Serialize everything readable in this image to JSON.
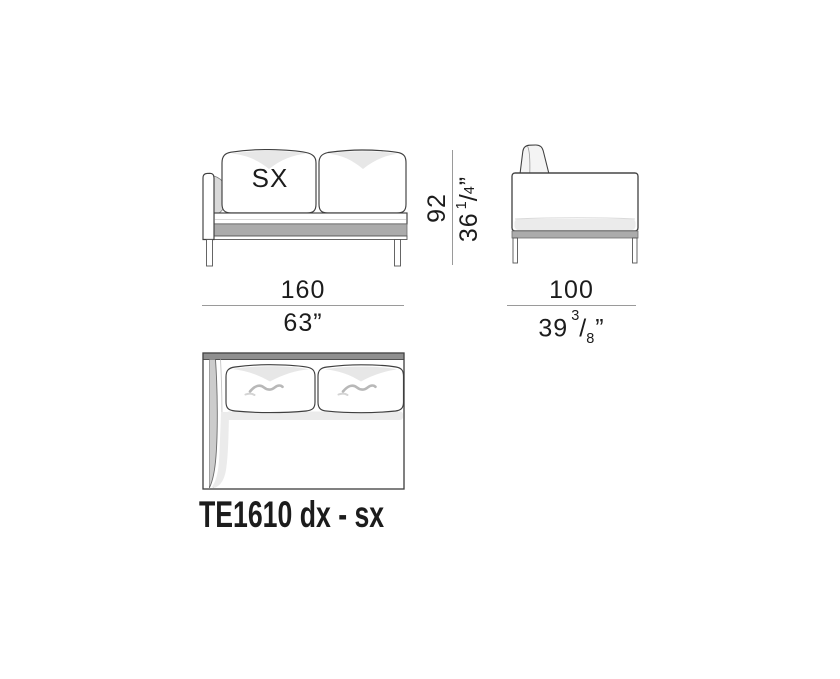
{
  "product": {
    "code": "TE1610 dx - sx",
    "orientation": "SX"
  },
  "dimensions": {
    "width": {
      "cm": "160",
      "inches": "63”"
    },
    "depth": {
      "cm": "100",
      "in_whole": "39",
      "in_num": "3",
      "in_slash": "/",
      "in_den": "8",
      "in_unit": "”"
    },
    "height": {
      "cm": "92",
      "in_whole": "36",
      "in_num": "1",
      "in_slash": "/",
      "in_den": "4",
      "in_unit": "”"
    }
  },
  "colors": {
    "background": "#ffffff",
    "outline": "#3f3f3f",
    "dimension_line": "#9a9a9a",
    "text": "#1c1c1c",
    "band_gray": "#ababab",
    "panel_gray": "#8f8f8f",
    "shading_light": "#ebebeb",
    "shading_mid": "#d9d9d9"
  }
}
